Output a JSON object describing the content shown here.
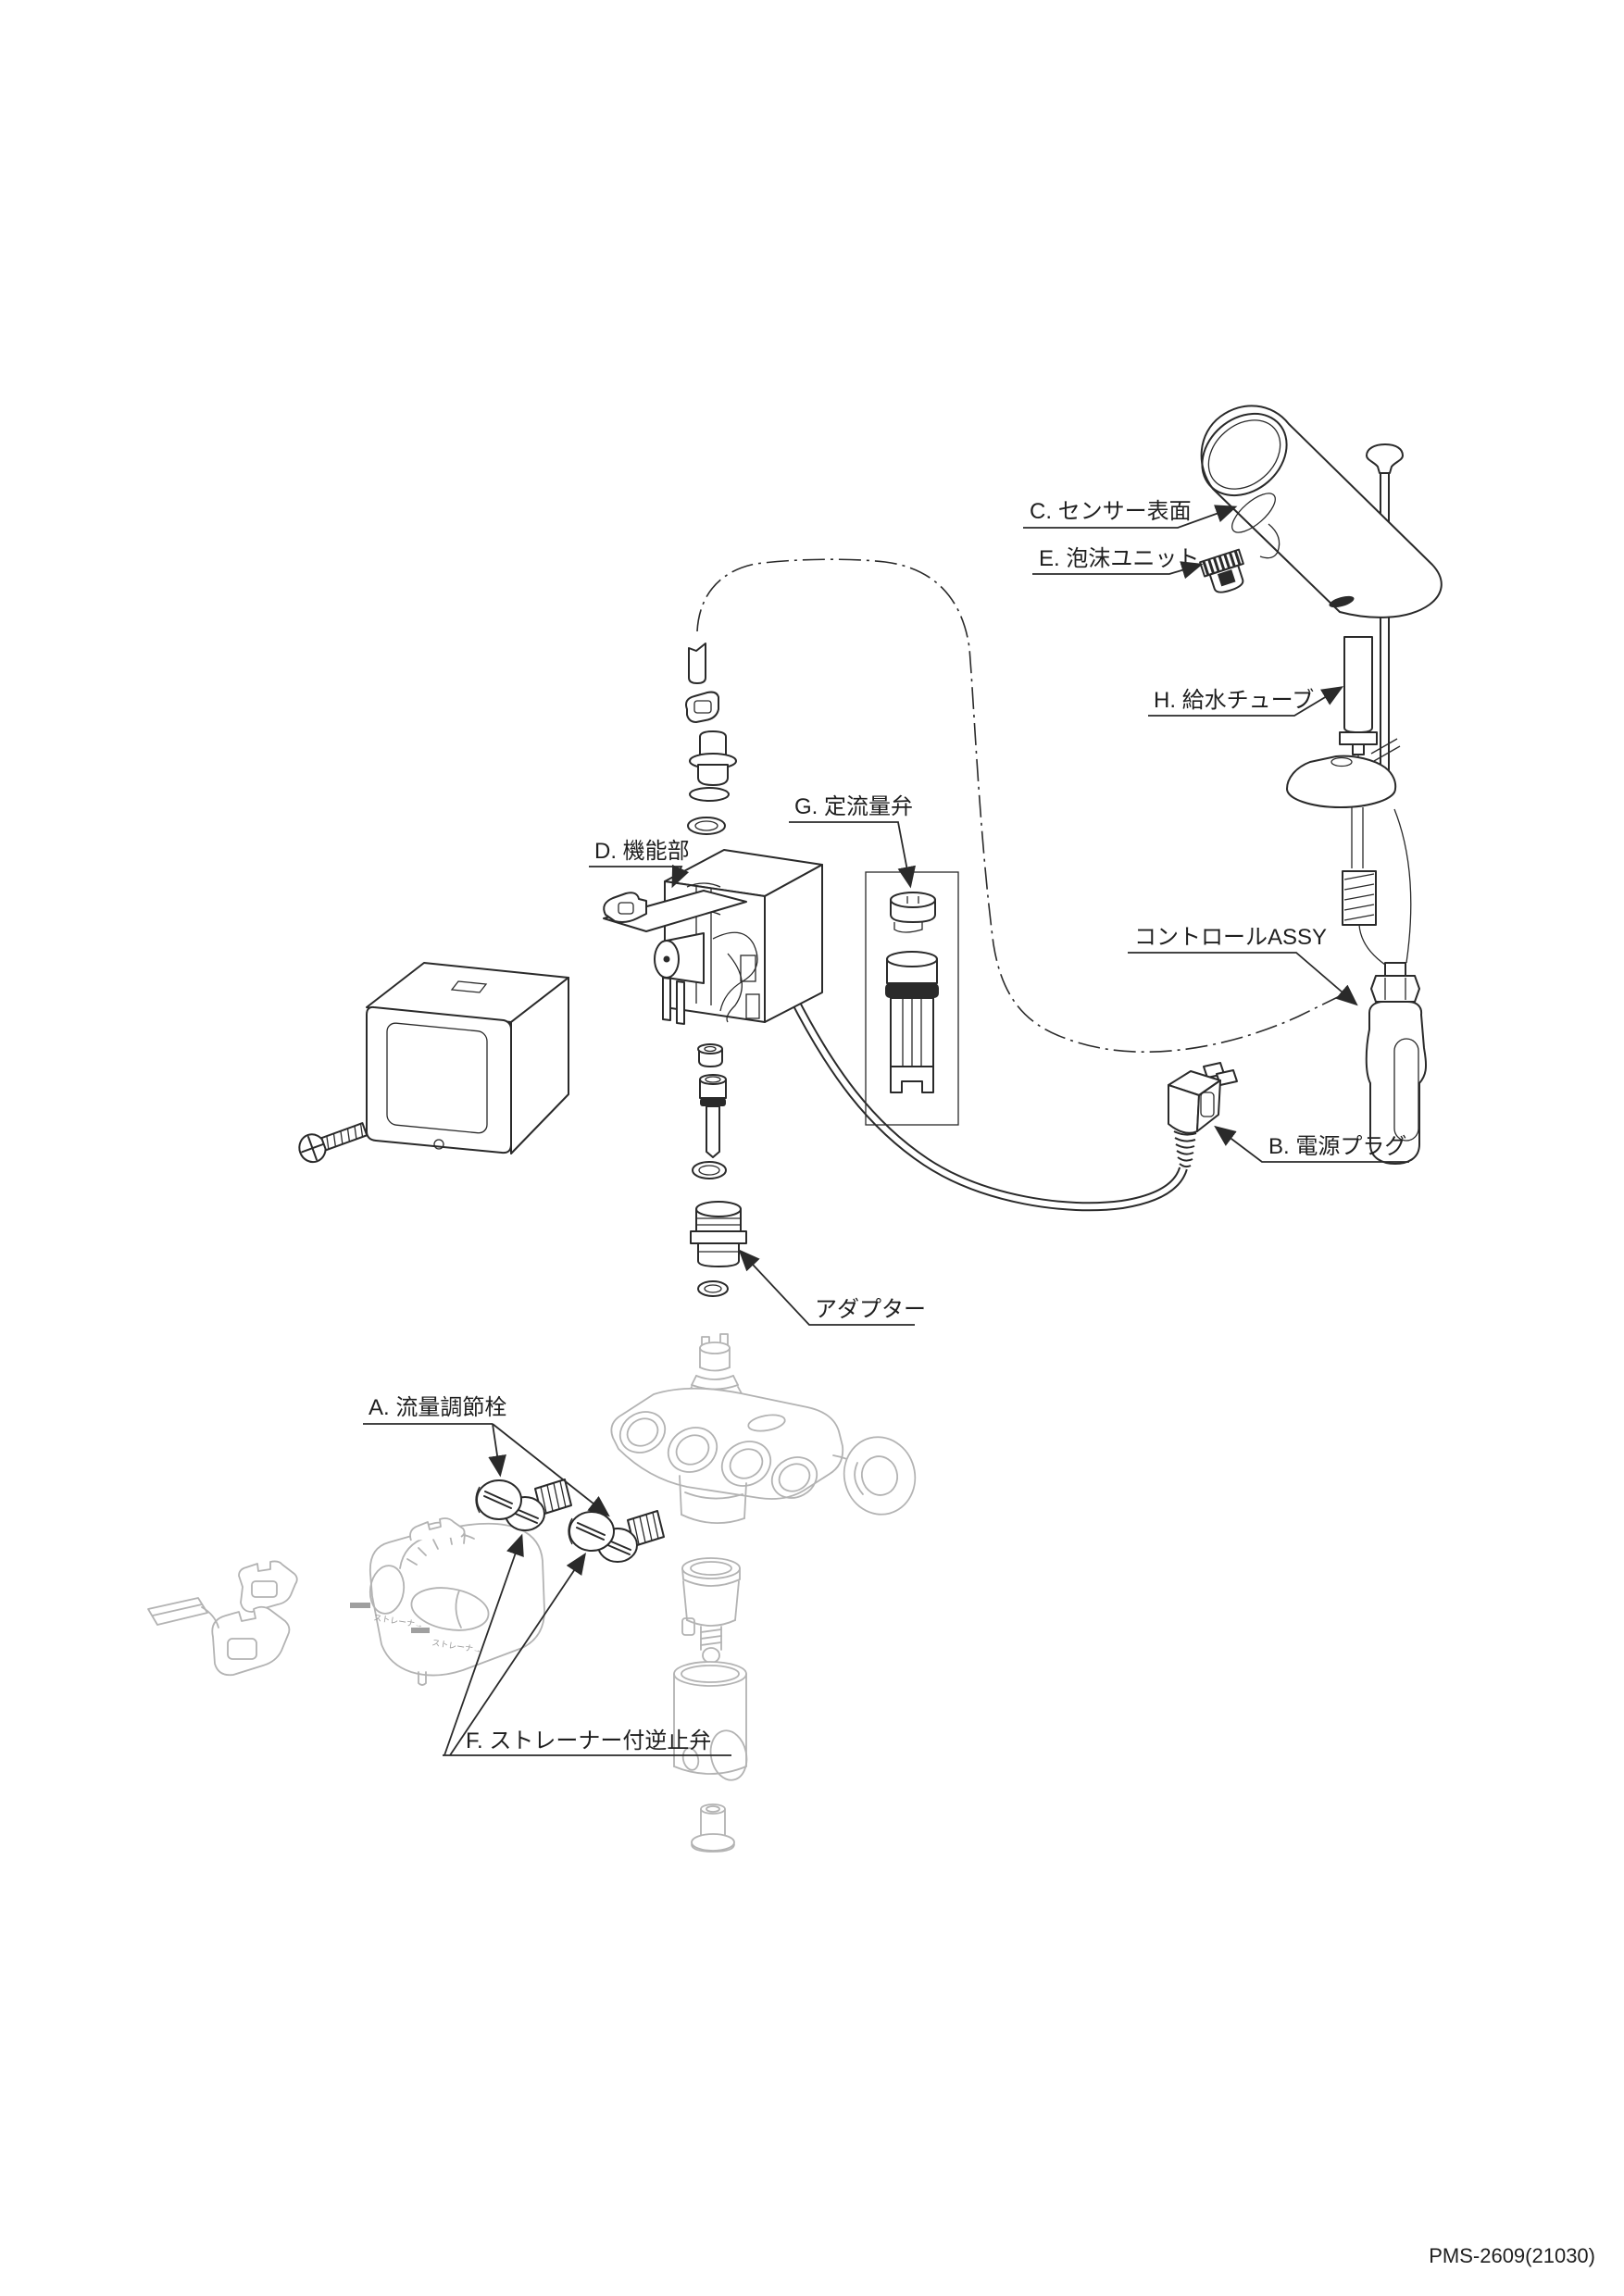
{
  "diagram_title": "faucet exploded parts diagram",
  "labels": {
    "sensor_surface": "C. センサー表面",
    "aerator_unit": "E. 泡沫ユニット",
    "supply_tube": "H. 給水チューブ",
    "flow_valve": "G. 定流量弁",
    "function_unit": "D. 機能部",
    "control_assy": "コントロールASSY",
    "power_plug": "B. 電源プラグ",
    "adapter": "アダプター",
    "flow_adjust": "A. 流量調節栓",
    "check_valve": "F. ストレーナー付逆止弁"
  },
  "molded_text": "ストレーナ→",
  "footer": {
    "doc_number": "PMS-2609(21030)"
  },
  "colors": {
    "line": "#2a2a2a",
    "ghost_line": "#b3b3b3",
    "background": "#ffffff"
  }
}
